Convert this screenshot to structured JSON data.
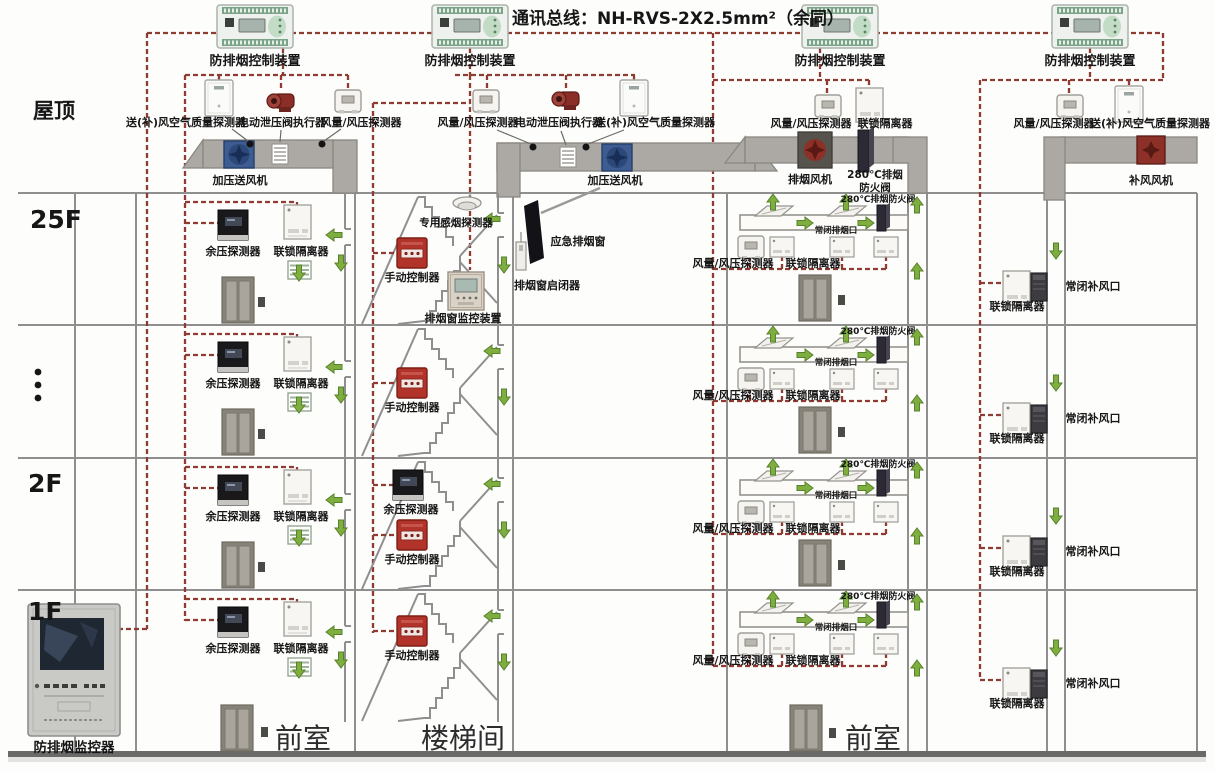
{
  "title": "通讯总线：NH-RVS-2X2.5mm²（余同）",
  "colors": {
    "bus_wire": "#8e3b31",
    "airflow_arrow": "#7fae3f",
    "structure": "#8f8f8f"
  },
  "floors": {
    "roof": "屋顶",
    "f25": "25F",
    "ellipsis": "⋮",
    "f2": "2F",
    "f1": "1F"
  },
  "labels": {
    "controller": "防排烟控制装置",
    "air_quality_detector": "送(补)风空气质量探测器",
    "relief_valve_actuator": "电动泄压阀执行器",
    "flow_pressure_detector": "风量/风压探测器",
    "pressurization_fan": "加压送风机",
    "exhaust_fan": "排烟风机",
    "fire_damper_line1": "280℃排烟",
    "fire_damper_line2": "防火阀",
    "fire_damper": "280℃排烟防火阀",
    "makeup_fan": "补风风机",
    "interlock_isolator": "联锁隔离器",
    "residual_pressure_detector": "余压探测器",
    "manual_controller": "手动控制器",
    "dedicated_smoke_detector": "专用感烟探测器",
    "emergency_smoke_window": "应急排烟窗",
    "smoke_window_actuator": "排烟窗启闭器",
    "smoke_window_monitor": "排烟窗监控装置",
    "nc_exhaust_vent": "常闭排烟口",
    "nc_makeup_vent": "常闭补风口",
    "monitor_host": "防排烟监控器",
    "front_room": "前室",
    "stairwell": "楼梯间"
  }
}
